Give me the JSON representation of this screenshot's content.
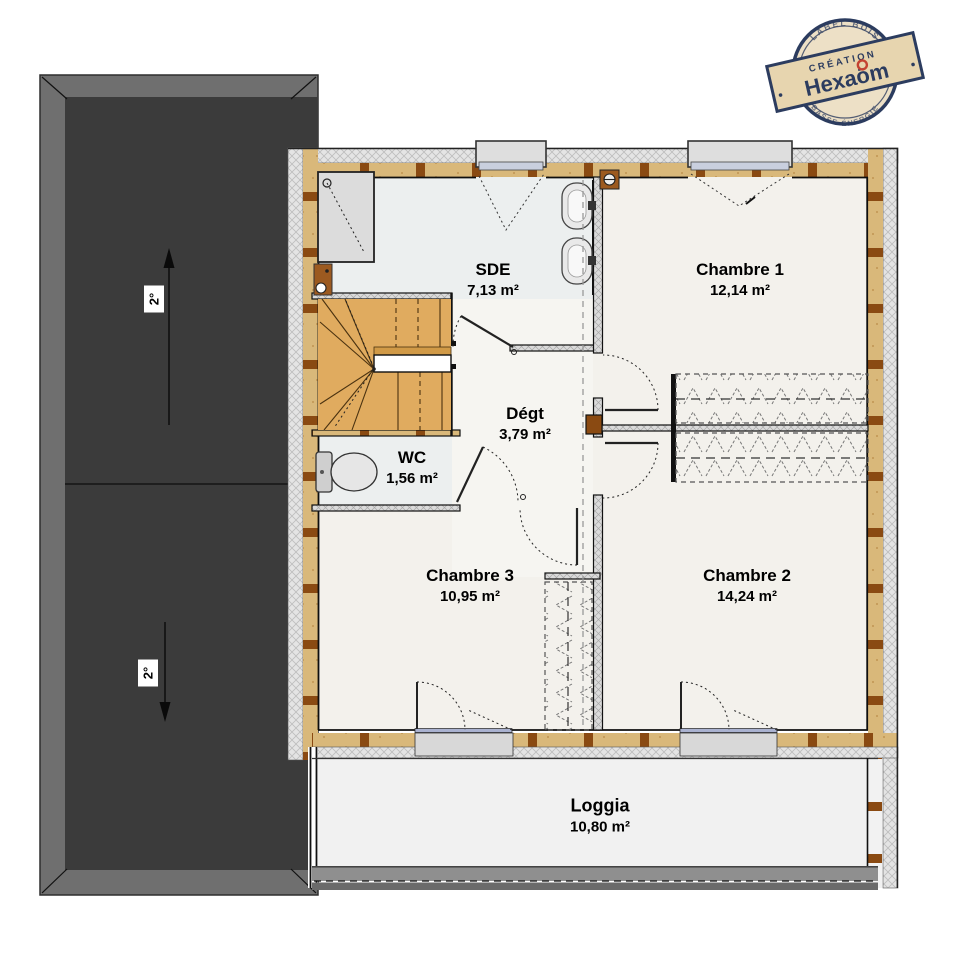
{
  "page": {
    "background": "#FFFFFF"
  },
  "stamp": {
    "arc_top": "LABEL BOIS",
    "arc_bottom": "BASSE ÉNERGIE",
    "banner_line": "CRÉATION",
    "brand": "Hexaōm"
  },
  "roof": {
    "upper_slope_label": "2°",
    "lower_slope_label": "2°"
  },
  "rooms": {
    "sde": {
      "name": "SDE",
      "area": "7,13 m²"
    },
    "chambre1": {
      "name": "Chambre 1",
      "area": "12,14 m²"
    },
    "degt": {
      "name": "Dégt",
      "area": "3,79 m²"
    },
    "wc": {
      "name": "WC",
      "area": "1,56 m²"
    },
    "chambre3": {
      "name": "Chambre 3",
      "area": "10,95 m²"
    },
    "chambre2": {
      "name": "Chambre 2",
      "area": "14,24 m²"
    },
    "loggia": {
      "name": "Loggia",
      "area": "10,80 m²"
    }
  },
  "colors": {
    "roof_dark": "#3B3B3B",
    "roof_frame": "#6F6F6F",
    "wall_tan": "#D9B87A",
    "stud_brown": "#8A4A12",
    "stairs_wood": "#E0AB5F",
    "floor_cream": "#F3F1EC",
    "wet_room_floor": "#ECEFEF",
    "loggia_floor": "#F1F1F1",
    "railing_gray": "#6A6A6A",
    "glazing_blue": "#AAB2D0",
    "stamp_navy": "#243559",
    "stamp_paper": "#EDDFC4",
    "stamp_red": "#C23B2A"
  }
}
